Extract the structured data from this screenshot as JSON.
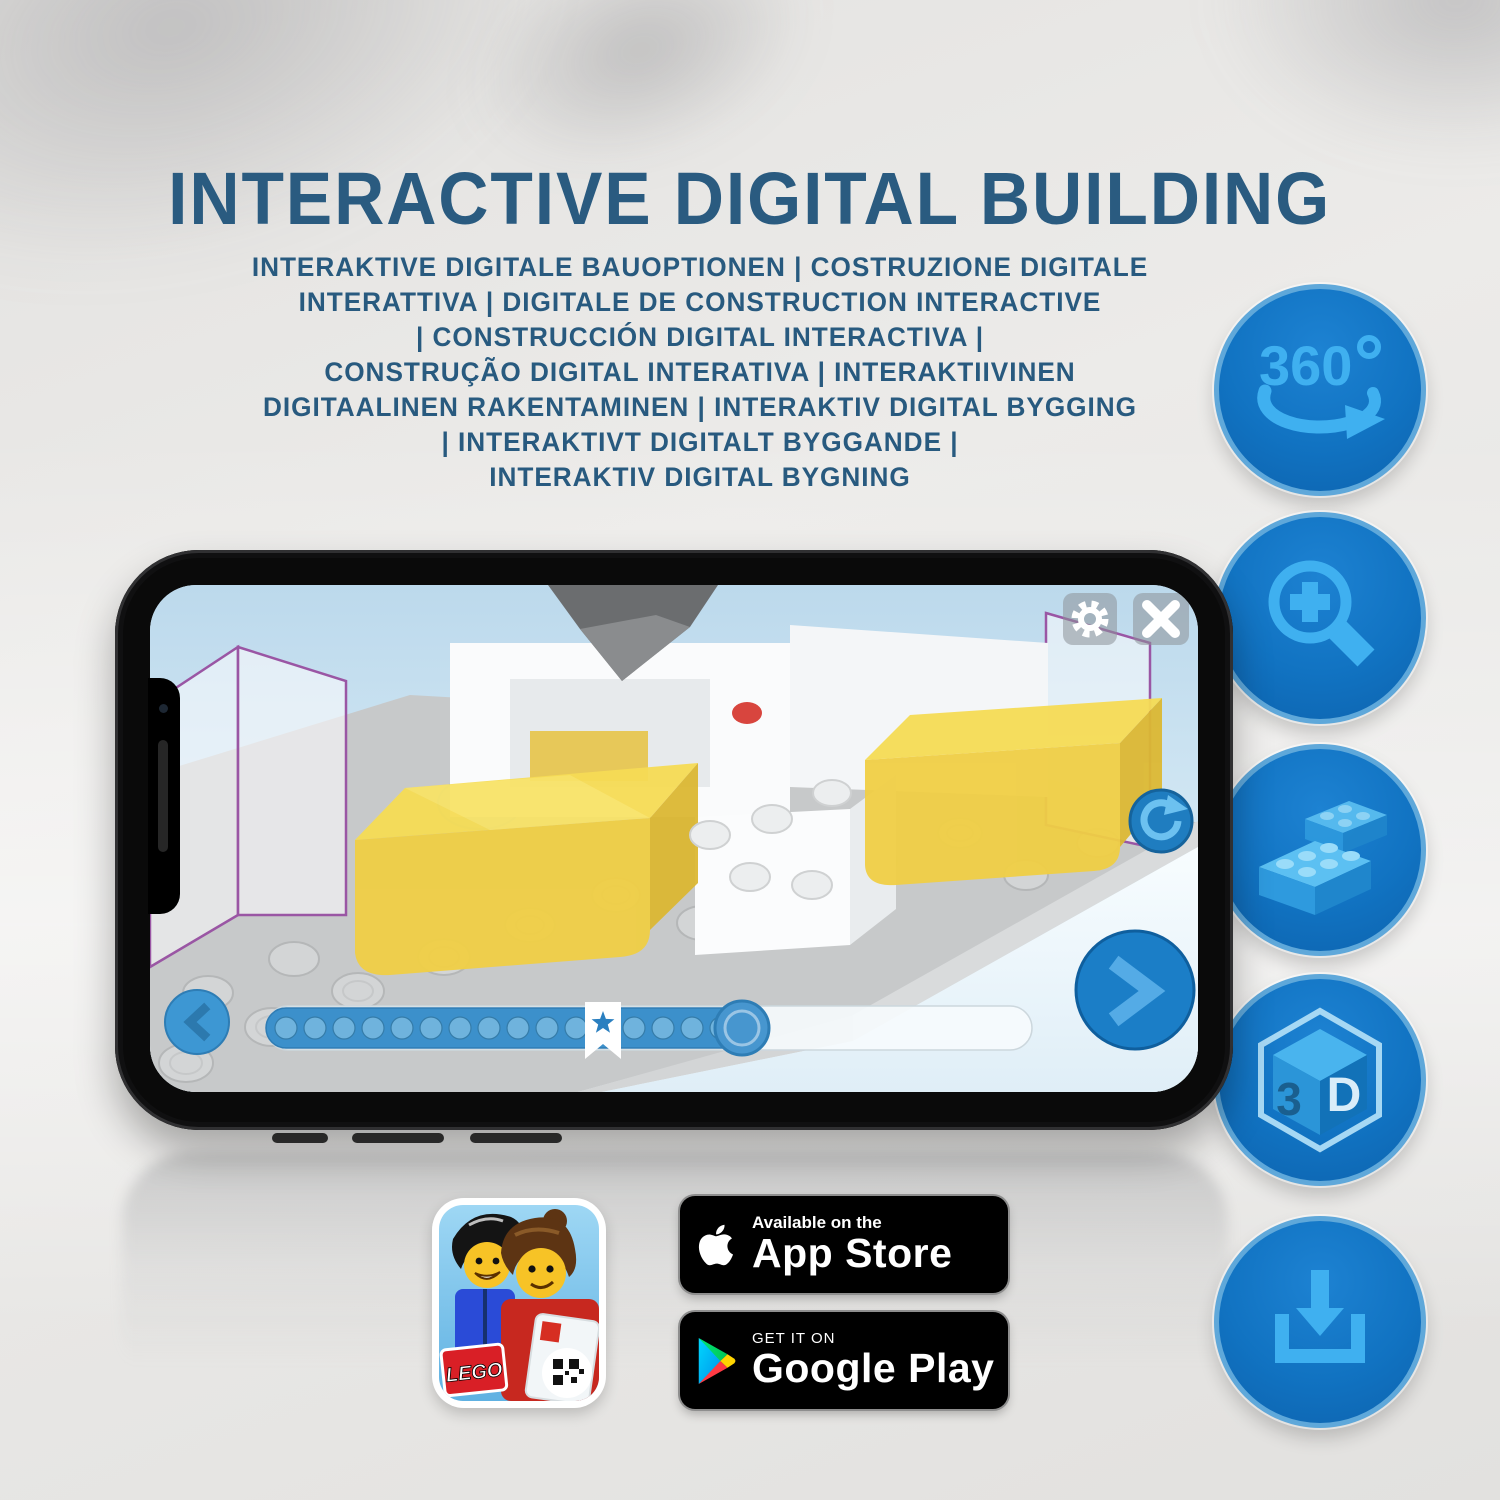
{
  "title": "INTERACTIVE DIGITAL BUILDING",
  "subtitle_lines": [
    "INTERAKTIVE DIGITALE BAUOPTIONEN | COSTRUZIONE DIGITALE",
    "INTERATTIVA | DIGITALE DE CONSTRUCTION INTERACTIVE",
    "| CONSTRUCCIÓN DIGITAL INTERACTIVA |",
    "CONSTRUÇÃO DIGITAL INTERATIVA | INTERAKTIIVINEN",
    "DIGITAALINEN RAKENTAMINEN | INTERAKTIV DIGITAL BYGGING",
    "| INTERAKTIVT DIGITALT BYGGANDE |",
    "INTERAKTIV DIGITAL BYGNING"
  ],
  "colors": {
    "heading": "#2a5b80",
    "icon_circle": "#1173c2",
    "icon_ring": "#5fa8da",
    "icon_glyph": "#3fb0f0",
    "app_accent_blue": "#3c90cb",
    "brick_yellow": "#f0cf45"
  },
  "feature_icons": [
    {
      "name": "360-degrees-rotation",
      "label": "360"
    },
    {
      "name": "zoom-in-magnifier"
    },
    {
      "name": "building-bricks"
    },
    {
      "name": "3d-view-cube",
      "face_left": "3",
      "face_right": "D"
    },
    {
      "name": "download"
    }
  ],
  "phone_app": {
    "toolbar": {
      "settings": "gear-icon",
      "close": "close-icon"
    },
    "rotate_button": "rotate-clockwise-icon",
    "controls": {
      "back": "chevron-left-icon",
      "next": "chevron-right-icon",
      "progress": {
        "dots_total": 16,
        "bookmark": "star-marker",
        "thumb_position_pct": 67
      }
    }
  },
  "badges": {
    "lego_app": {
      "logo": "LEGO"
    },
    "app_store": {
      "tagline": "Available on the",
      "store": "App Store"
    },
    "google_play": {
      "tagline": "GET IT ON",
      "store": "Google Play"
    }
  }
}
